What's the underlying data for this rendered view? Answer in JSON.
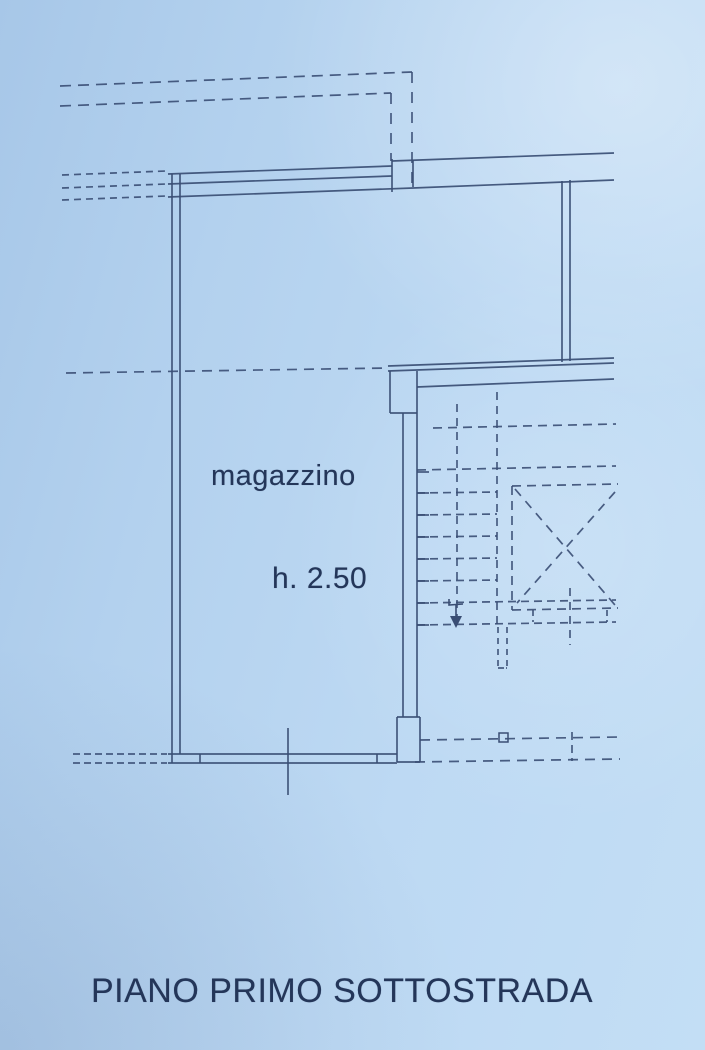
{
  "colors": {
    "paper": "#b9d6f0",
    "ink": "#3a4e74",
    "text": "#243659"
  },
  "plan": {
    "width": 705,
    "height": 1050,
    "labels": [
      {
        "name": "room-name",
        "text": "magazzino"
      },
      {
        "name": "room-height",
        "text": "h. 2.50"
      },
      {
        "name": "floor-title",
        "text": "PIANO PRIMO SOTTOSTRADA"
      }
    ],
    "solid_lines": [
      [
        172,
        174,
        172,
        763
      ],
      [
        180,
        174,
        180,
        754
      ],
      [
        168,
        174,
        392,
        166
      ],
      [
        168,
        184,
        392,
        176
      ],
      [
        168,
        197,
        413,
        188
      ],
      [
        392,
        159,
        392,
        192
      ],
      [
        392,
        161,
        614,
        153
      ],
      [
        413,
        160,
        413,
        187
      ],
      [
        413,
        188,
        614,
        180
      ],
      [
        562,
        181,
        562,
        362
      ],
      [
        570,
        180,
        570,
        361
      ],
      [
        388,
        366,
        614,
        358
      ],
      [
        388,
        371,
        614,
        363
      ],
      [
        417,
        387,
        614,
        379
      ],
      [
        390,
        371,
        390,
        413
      ],
      [
        417,
        371,
        417,
        413
      ],
      [
        390,
        413,
        417,
        413
      ],
      [
        403,
        413,
        403,
        717
      ],
      [
        417,
        413,
        417,
        717
      ],
      [
        397,
        717,
        397,
        762
      ],
      [
        420,
        717,
        420,
        762
      ],
      [
        397,
        717,
        420,
        717
      ],
      [
        397,
        762,
        420,
        762
      ],
      [
        168,
        754,
        397,
        754
      ],
      [
        168,
        763,
        397,
        763
      ],
      [
        200,
        754,
        200,
        763
      ],
      [
        377,
        754,
        377,
        763
      ],
      [
        288,
        728,
        288,
        795
      ],
      [
        417,
        472,
        429,
        472
      ],
      [
        417,
        493,
        429,
        493
      ],
      [
        417,
        515,
        429,
        515
      ],
      [
        417,
        537,
        429,
        537
      ],
      [
        417,
        559,
        429,
        559
      ],
      [
        417,
        581,
        429,
        581
      ],
      [
        417,
        603,
        429,
        603
      ],
      [
        417,
        625,
        429,
        625
      ]
    ],
    "dashed_lines": [
      {
        "d": "11,7",
        "l": [
          60,
          86,
          412,
          72
        ]
      },
      {
        "d": "11,9",
        "l": [
          412,
          72,
          412,
          186
        ]
      },
      {
        "d": "11,7",
        "l": [
          60,
          106,
          391,
          93
        ]
      },
      {
        "d": "11,9",
        "l": [
          391,
          93,
          391,
          161
        ]
      },
      {
        "d": "7,5",
        "l": [
          62,
          175,
          166,
          171
        ]
      },
      {
        "d": "7,5",
        "l": [
          62,
          188,
          166,
          184
        ]
      },
      {
        "d": "7,5",
        "l": [
          62,
          200,
          166,
          196
        ]
      },
      {
        "d": "10,7",
        "l": [
          66,
          373,
          388,
          368
        ]
      },
      {
        "d": "7,4",
        "l": [
          73,
          754,
          167,
          754
        ]
      },
      {
        "d": "7,4",
        "l": [
          73,
          763,
          167,
          763
        ]
      },
      {
        "d": "9,6",
        "l": [
          433,
          428,
          616,
          424
        ]
      },
      {
        "d": "9,6",
        "l": [
          417,
          470,
          616,
          466
        ]
      },
      {
        "d": "9,6",
        "l": [
          512,
          486,
          618,
          484
        ]
      },
      {
        "d": "9,6",
        "l": [
          512,
          486,
          512,
          610
        ]
      },
      {
        "d": "9,6",
        "l": [
          512,
          610,
          618,
          608
        ]
      },
      {
        "d": "9,7",
        "l": [
          515,
          489,
          615,
          605
        ]
      },
      {
        "d": "9,7",
        "l": [
          615,
          492,
          517,
          603
        ]
      },
      {
        "d": "8,5",
        "l": [
          417,
          493,
          497,
          492
        ]
      },
      {
        "d": "8,5",
        "l": [
          417,
          515,
          497,
          514
        ]
      },
      {
        "d": "8,5",
        "l": [
          417,
          537,
          497,
          536
        ]
      },
      {
        "d": "8,5",
        "l": [
          417,
          559,
          497,
          558
        ]
      },
      {
        "d": "8,5",
        "l": [
          417,
          581,
          497,
          580
        ]
      },
      {
        "d": "8,5",
        "l": [
          417,
          603,
          616,
          600
        ]
      },
      {
        "d": "8,5",
        "l": [
          417,
          625,
          616,
          622
        ]
      },
      {
        "d": "8,6",
        "l": [
          457,
          404,
          457,
          622
        ]
      },
      {
        "d": "8,6",
        "l": [
          497,
          392,
          497,
          625
        ]
      },
      {
        "d": "6,5",
        "l": [
          498,
          627,
          498,
          666
        ]
      },
      {
        "d": "6,5",
        "l": [
          507,
          627,
          507,
          666
        ]
      },
      {
        "d": "6,2",
        "l": [
          498,
          668,
          507,
          668
        ]
      },
      {
        "d": "8,6",
        "l": [
          570,
          588,
          570,
          645
        ]
      },
      {
        "d": "6,4",
        "l": [
          533,
          610,
          533,
          622
        ]
      },
      {
        "d": "6,4",
        "l": [
          607,
          610,
          607,
          622
        ]
      },
      {
        "d": "10,7",
        "l": [
          420,
          740,
          620,
          737
        ]
      },
      {
        "d": "10,7",
        "l": [
          415,
          762,
          620,
          759
        ]
      },
      {
        "d": "8,5",
        "l": [
          572,
          732,
          572,
          761
        ]
      }
    ],
    "small_rects": [
      {
        "x": 499,
        "y": 733,
        "w": 9,
        "h": 9
      }
    ],
    "arrow": {
      "hook": [
        449,
        599,
        449,
        605,
        463,
        604
      ],
      "shaft": [
        456,
        604,
        456,
        618
      ],
      "head": [
        [
          450,
          616
        ],
        [
          456,
          628
        ],
        [
          462,
          616
        ]
      ]
    }
  }
}
